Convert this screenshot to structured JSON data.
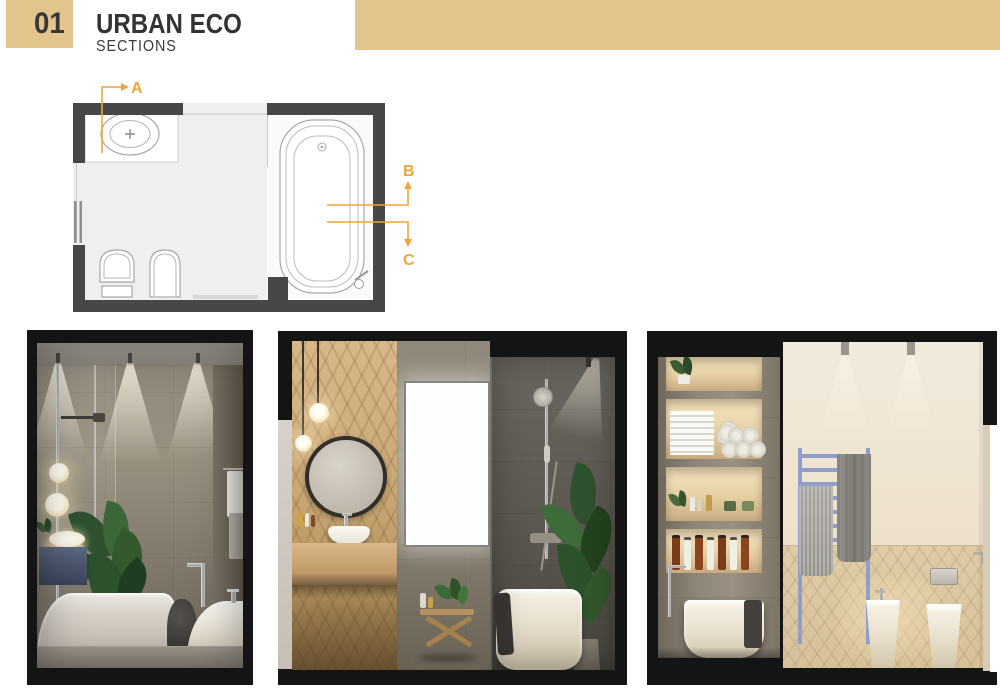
{
  "palette": {
    "tan": "#E2C48D",
    "orange": "#F0A43C",
    "ink": "#333333",
    "frame": "#141414",
    "wall_dark": "#474747",
    "floor_light": "#EFEFF0"
  },
  "header": {
    "index_number": "01",
    "title": "URBAN ECO",
    "subtitle": "SECTIONS"
  },
  "floor_plan": {
    "markers": [
      {
        "label": "A"
      },
      {
        "label": "B"
      },
      {
        "label": "C"
      }
    ]
  }
}
